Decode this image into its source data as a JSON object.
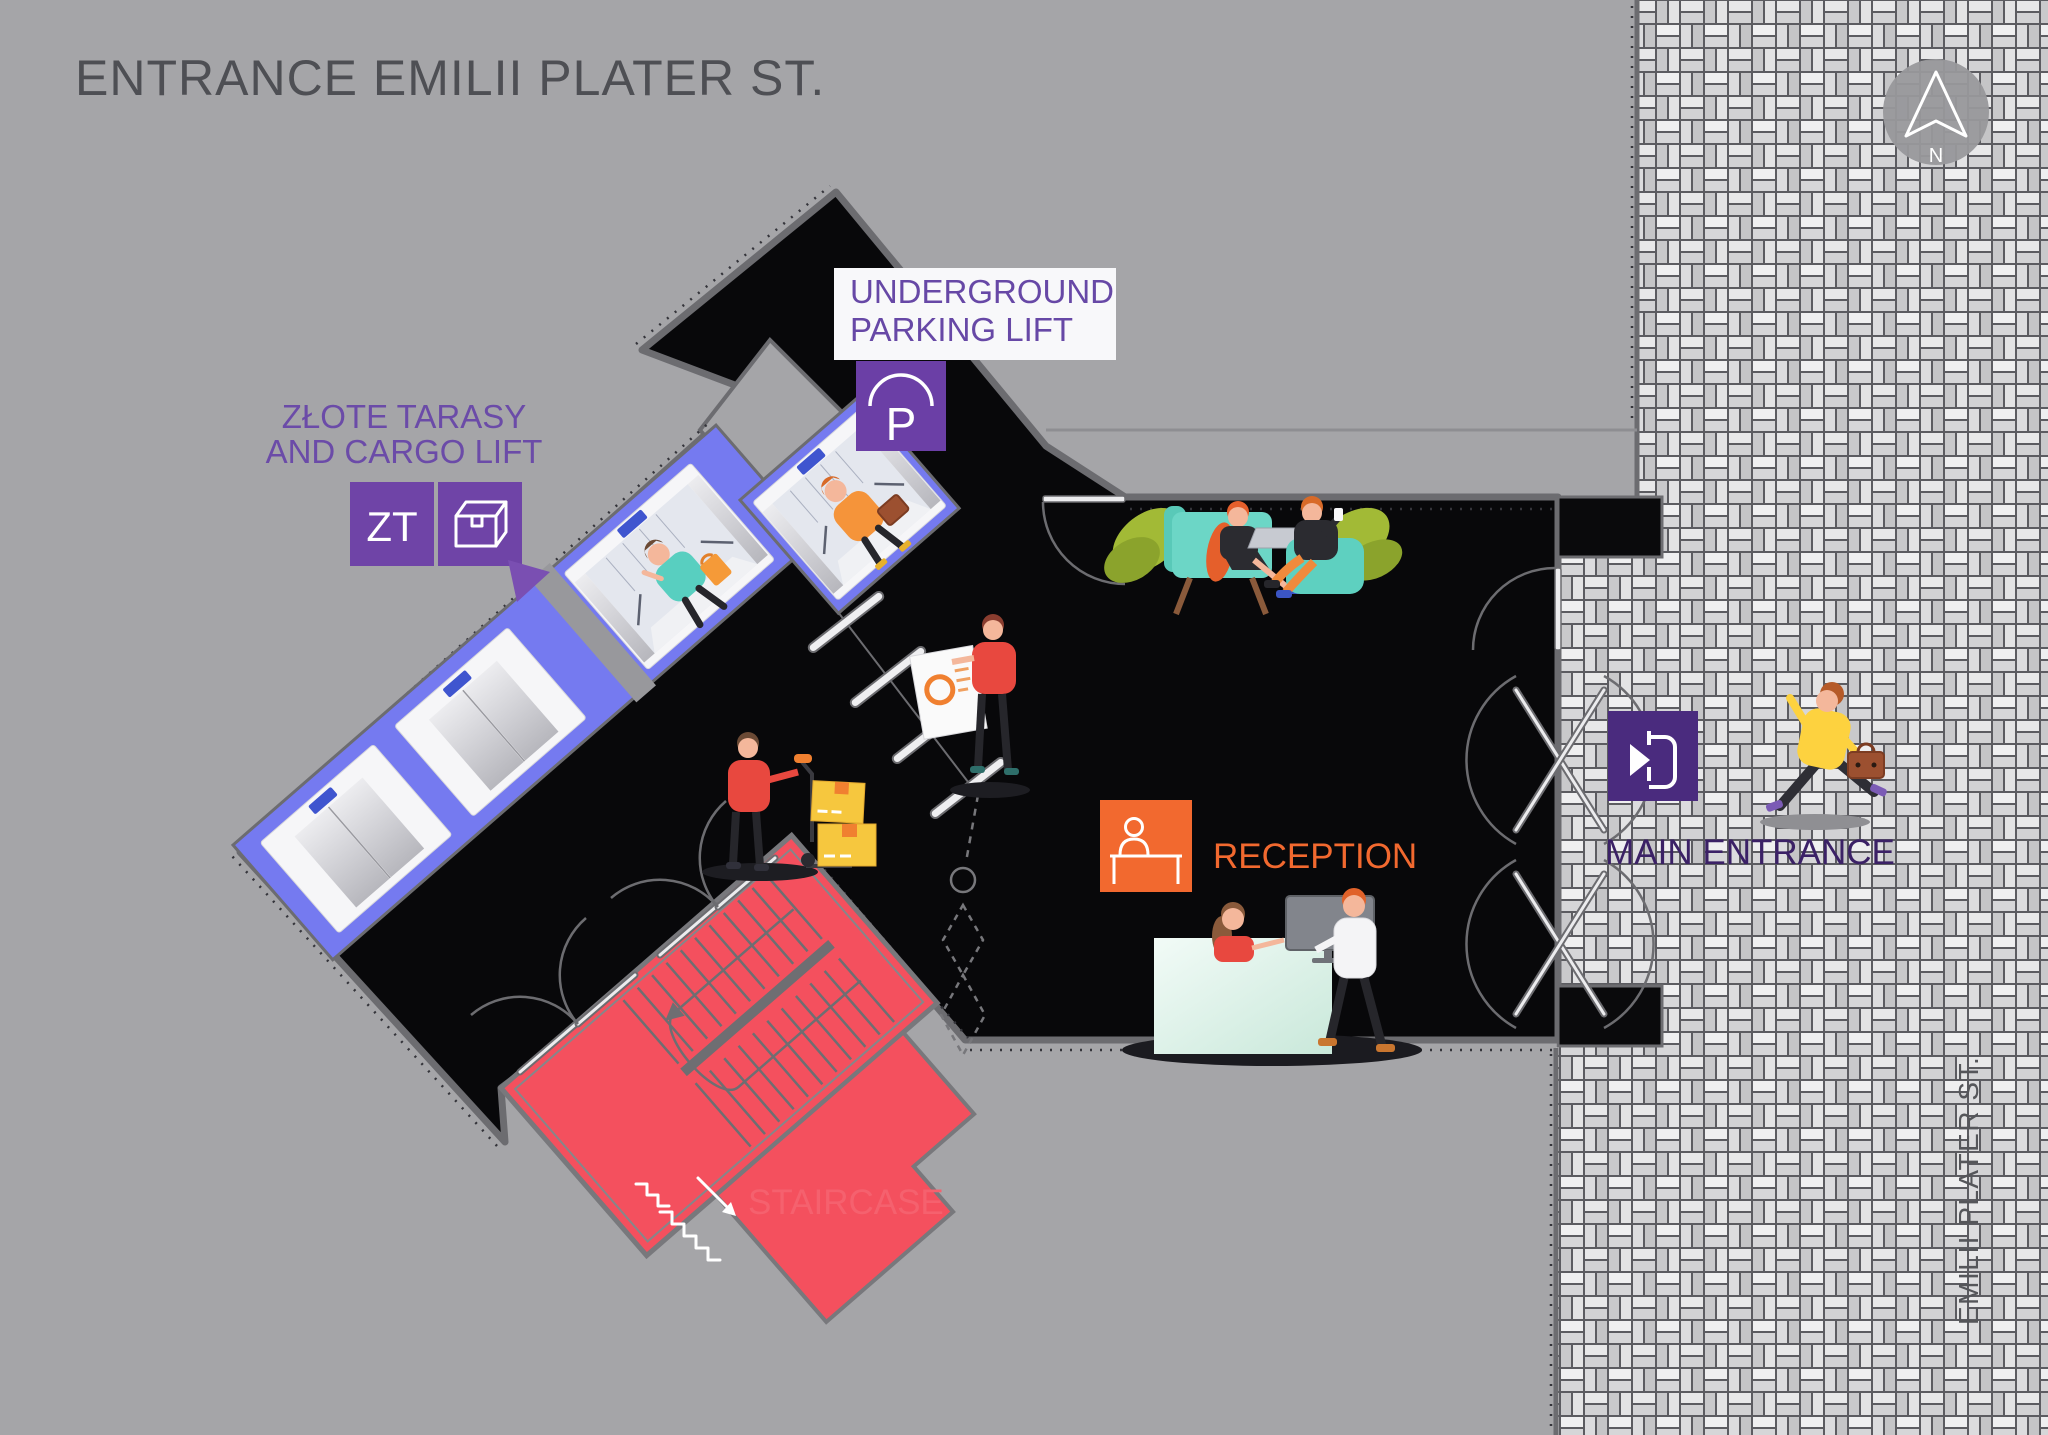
{
  "title": "ENTRANCE EMILII PLATER ST.",
  "compass": {
    "label": "N"
  },
  "street": {
    "label": "EMILII PLATER ST."
  },
  "areas": {
    "underground_parking_lift": {
      "line1": "UNDERGROUND",
      "line2": "PARKING LIFT",
      "badge": "P"
    },
    "zlote_tarasy_cargo_lift": {
      "line1": "ZŁOTE TARASY",
      "line2": "AND CARGO LIFT",
      "badge": "ZT"
    },
    "reception": {
      "label": "RECEPTION"
    },
    "main_entrance": {
      "label": "MAIN ENTRANCE"
    },
    "staircase": {
      "label": "STAIRCASE"
    }
  },
  "icons": [
    "north-compass-icon",
    "parking-lift-icon",
    "zt-badge-icon",
    "cargo-box-icon",
    "direction-pointer-icon",
    "reception-desk-icon",
    "enter-door-icon",
    "stairs-down-icon"
  ],
  "colors": {
    "background": "#a5a5a8",
    "floor_black": "#08080a",
    "lift_band": "#757af0",
    "purple_badge": "#6b3fa6",
    "purple_text": "#6748a6",
    "purple_dark": "#3b2166",
    "orange": "#f2692f",
    "coral": "#f4505e",
    "coral_text": "#f5616e",
    "wall_gray": "#6c6c70",
    "title_gray": "#4e4f54"
  }
}
